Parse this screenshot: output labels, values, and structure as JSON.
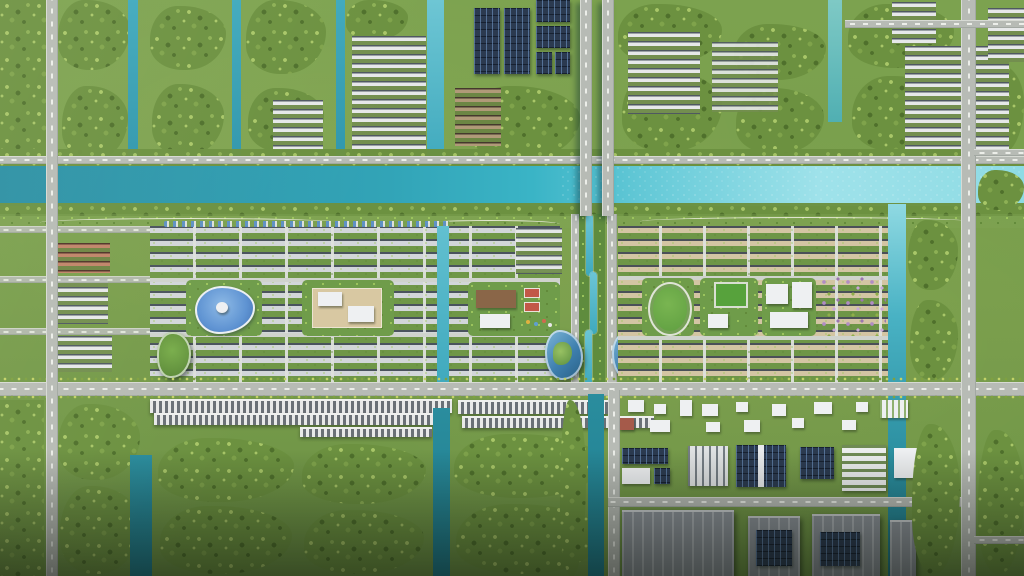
{
  "scene": {
    "description": "Aerial 3D masterplan rendering of a riverfront township: canal-laced farmland and a rooftop solar farm to the north, a turquoise river crossed by twin bridges, two gridded residential neighborhoods (slate-white roofs west, tan roofs east) around lagoon-pool and school amenity parks, a central winding canal greenway with glass towers, a tree-lined main boulevard with linear shophouse strips, and an industrial estate with solar-roofed warehouses to the southeast.",
    "regions": [
      {
        "id": "farm-grid-north",
        "label": "Farmland with irrigation canals and village clusters"
      },
      {
        "id": "solar-farm",
        "label": "Ground-mounted solar panel farm"
      },
      {
        "id": "river",
        "label": "Turquoise river"
      },
      {
        "id": "twin-bridges",
        "label": "Twin road bridges"
      },
      {
        "id": "riverside-park",
        "label": "Riverside linear park with paths"
      },
      {
        "id": "residential-west",
        "label": "Western residential grid with lagoon pool and clubhouse"
      },
      {
        "id": "residential-east",
        "label": "Eastern residential grid with oval park and school campus"
      },
      {
        "id": "central-greenway",
        "label": "Central canal greenway with glass towers"
      },
      {
        "id": "main-boulevard",
        "label": "Tree-lined main boulevard"
      },
      {
        "id": "shophouse-strips",
        "label": "Linear shophouse strips"
      },
      {
        "id": "industrial-park",
        "label": "Industrial estate with solar-roofed warehouses"
      },
      {
        "id": "perimeter-canals",
        "label": "Perimeter drainage canals"
      }
    ]
  },
  "palette": {
    "field": "#7a9f4d",
    "tree_light": "#a9c768",
    "tree_mid": "#6c9140",
    "tree_dark": "#4f702c",
    "river_deep": "#2a8fa3",
    "river_bright": "#9fe2ea",
    "canal": "#3fa9bd",
    "canal_dark": "#1f7c8c",
    "road": "#b7bbb5",
    "roof_white": "#d2d6d9",
    "roof_slate": "#4a535d",
    "roof_tan": "#d3c5a3",
    "solar": "#2b3a50",
    "pool": "#5d92d2",
    "glass": "#3e7fae",
    "green_tower": "#79ad4b",
    "bloom": "#b18cc4",
    "warehouse": "#8a9097",
    "white": "#eef0f2"
  }
}
